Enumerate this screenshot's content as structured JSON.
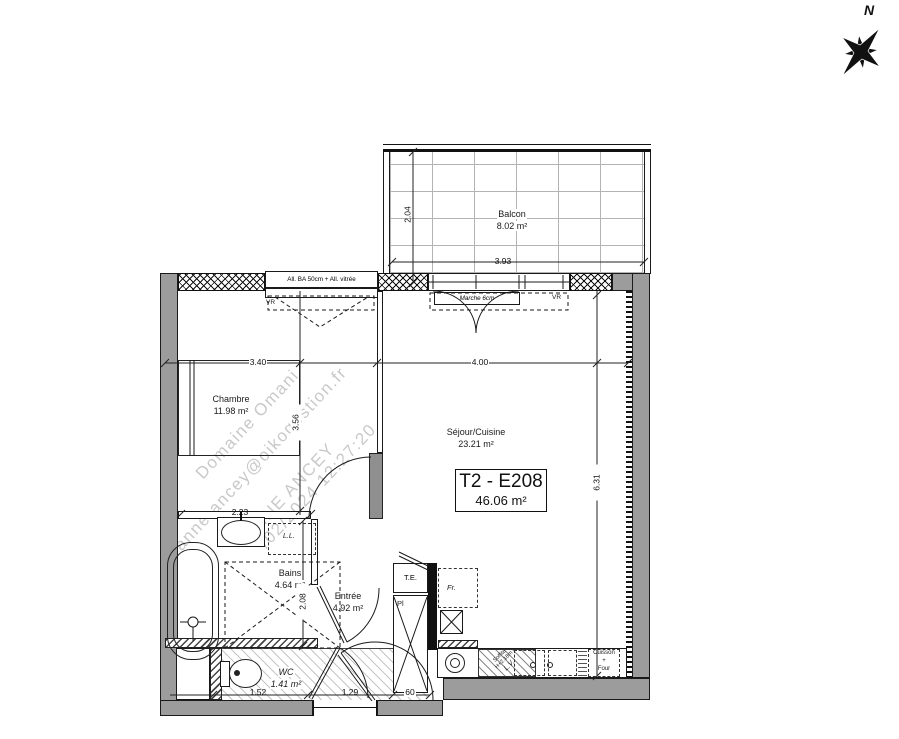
{
  "compass": {
    "north": "N"
  },
  "watermark": {
    "line1": "Domaine Omani",
    "line2": "anne.ancey@oikogestion.fr",
    "line3": "ANNE ANCEY",
    "line4": "/02/2024 12:27:20"
  },
  "unit": {
    "code": "T2 - E208",
    "area": "46.06 m²"
  },
  "rooms": {
    "balcon": {
      "name": "Balcon",
      "area": "8.02 m²"
    },
    "chambre": {
      "name": "Chambre",
      "area": "11.98 m²"
    },
    "sejour": {
      "name": "Séjour/Cuisine",
      "area": "23.21 m²"
    },
    "bains": {
      "name": "Bains",
      "area": "4.64 m²"
    },
    "entree": {
      "name": "Entrée",
      "area": "4.92 m²"
    },
    "wc": {
      "name": "WC",
      "area": "1.41 m²"
    }
  },
  "dims": {
    "balcon_depth": "2.04",
    "balcon_width": "3.93",
    "chambre_width": "3.40",
    "chambre_depth": "3.56",
    "sejour_width": "4.00",
    "sejour_depth": "6.31",
    "bains_width": "2.23",
    "bains_depth": "2.08",
    "wc_width": "1.52",
    "entree_width": "1.29",
    "placard_width": "60"
  },
  "annotations": {
    "allege": "All. BA 50cm + All. vitrée",
    "marche": "Marche 6cm",
    "vr": "VR",
    "lave_linge": "L.L.",
    "tableau_electrique": "T.E.",
    "frigo": "Fr.",
    "placard": "Pl",
    "soffite": [
      "Soffite",
      "H+2.18m",
      "L.V."
    ],
    "cuisson": [
      "Cuisson",
      "+",
      "Four"
    ]
  }
}
